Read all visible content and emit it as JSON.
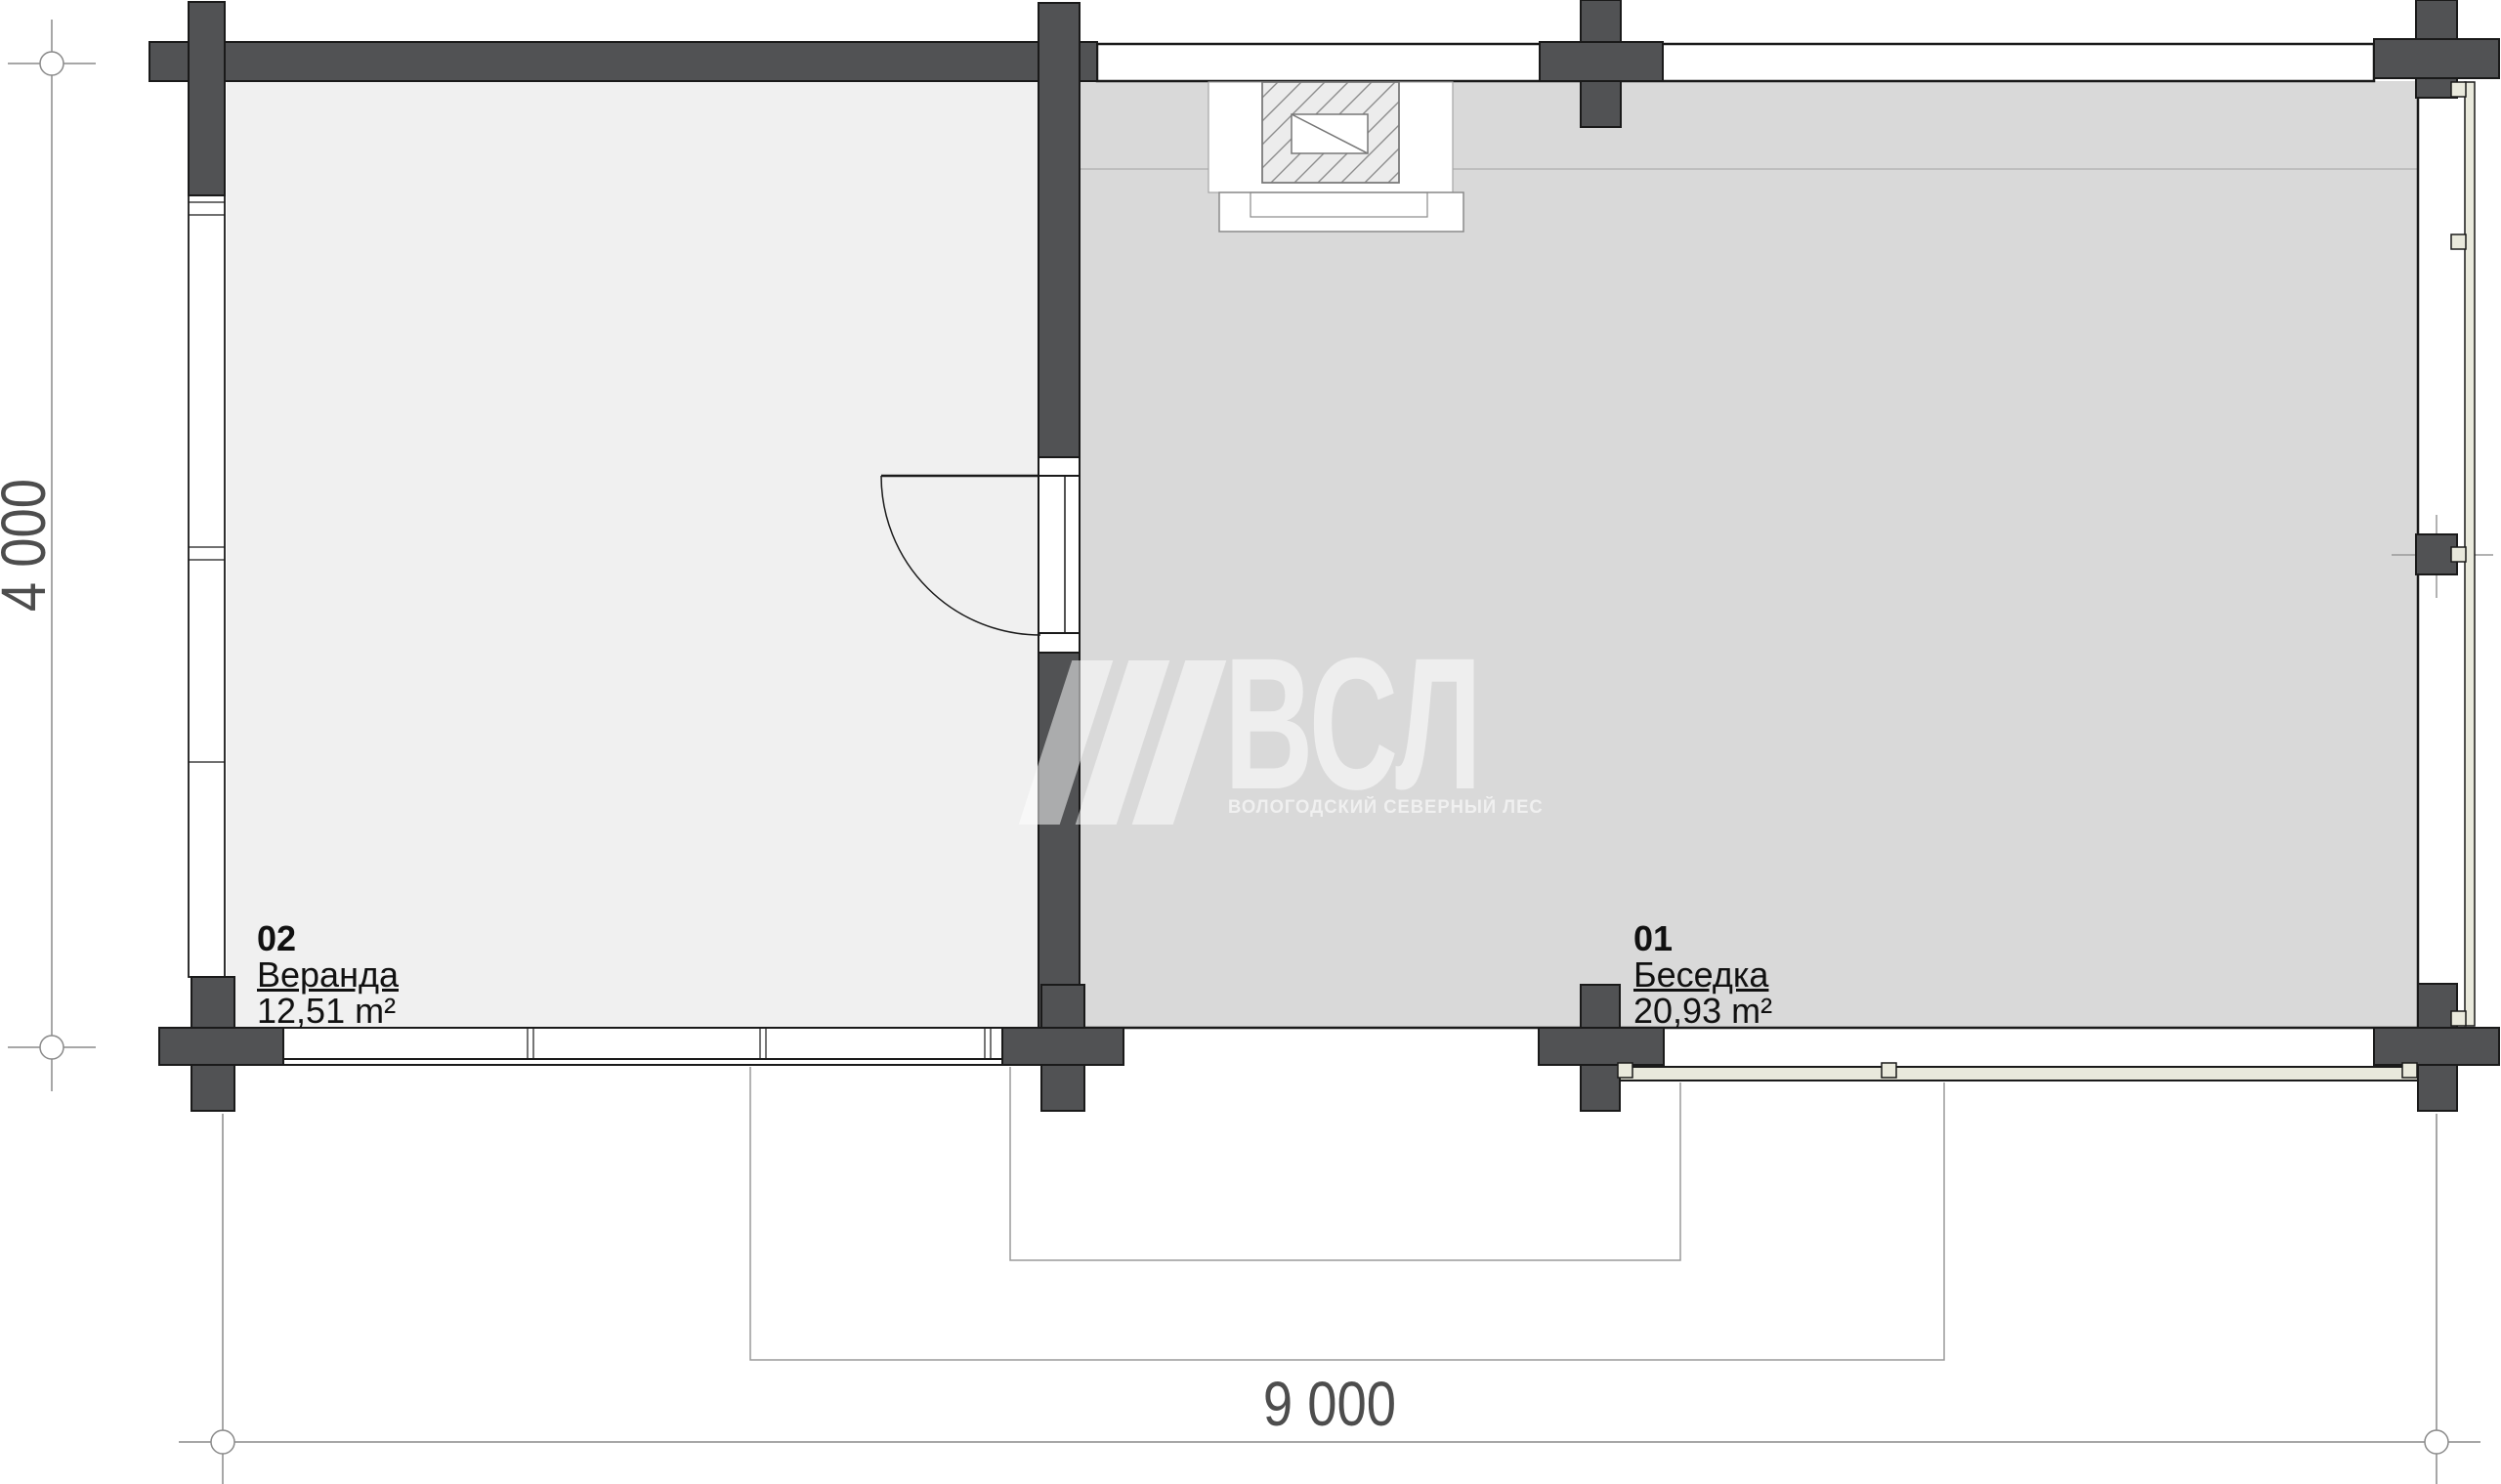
{
  "plan": {
    "type": "floor-plan",
    "rooms": [
      {
        "number": "01",
        "name": "Беседка",
        "area": "20,93 m²"
      },
      {
        "number": "02",
        "name": "Веранда",
        "area": "12,51 m²"
      }
    ],
    "dimensions": {
      "horizontal": "9 000",
      "vertical": "4 000"
    },
    "watermark": {
      "logo": "ВСЛ",
      "subtitle": "ВОЛОГОДСКИЙ СЕВЕРНЫЙ ЛЕС"
    },
    "colors": {
      "wall_dark": "#515254",
      "outline": "#1a1a1a",
      "veranda_fill": "#f0f0f0",
      "gazebo_fill": "#d9d9d9",
      "glazing_fill": "#e9e9dc",
      "dimension_line": "#8a8a8a",
      "text": "#111111"
    }
  }
}
